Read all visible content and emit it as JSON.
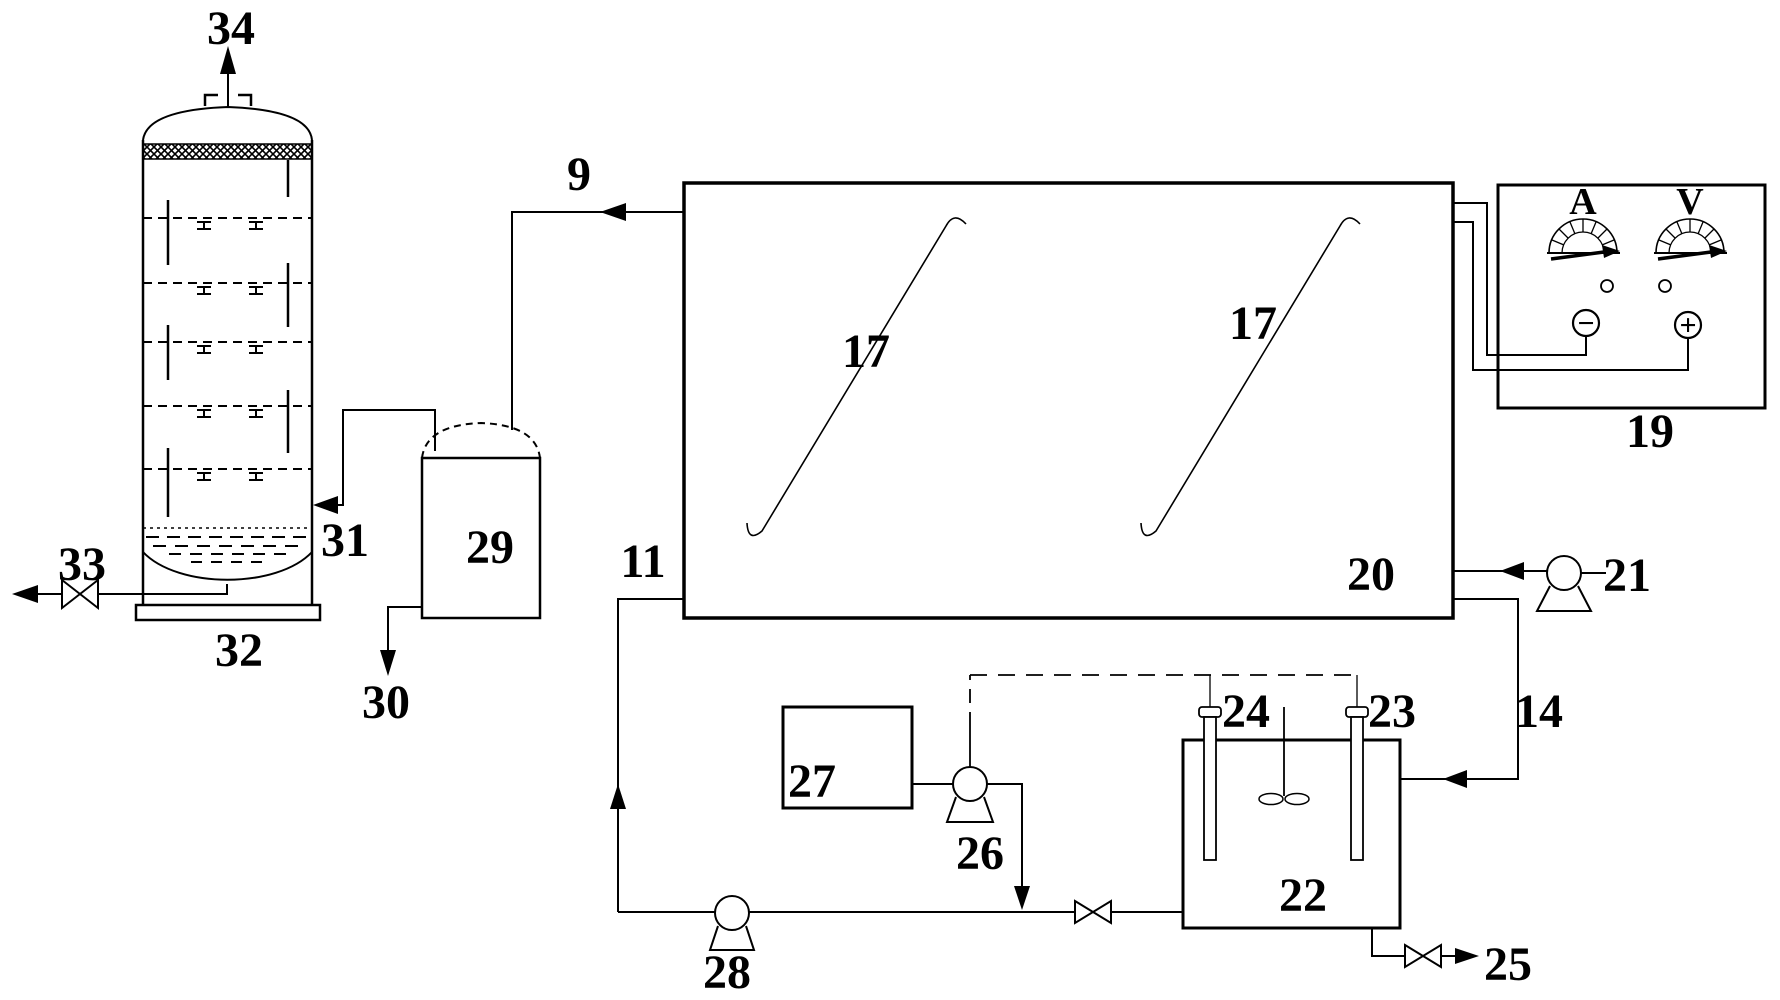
{
  "diagram": {
    "kind": "patent process flow diagram",
    "background_color": "#ffffff",
    "line_color": "#000000"
  },
  "labels": {
    "n9": "9",
    "n11": "11",
    "n14": "14",
    "n17a": "17",
    "n17b": "17",
    "n19": "19",
    "n20": "20",
    "n21": "21",
    "n22": "22",
    "n23": "23",
    "n24": "24",
    "n25": "25",
    "n26": "26",
    "n27": "27",
    "n28": "28",
    "n29": "29",
    "n30": "30",
    "n31": "31",
    "n32": "32",
    "n33": "33",
    "n34": "34"
  },
  "power_supply": {
    "ammeter_label": "A",
    "voltmeter_label": "V",
    "negative_terminal": "−",
    "positive_terminal": "+"
  }
}
